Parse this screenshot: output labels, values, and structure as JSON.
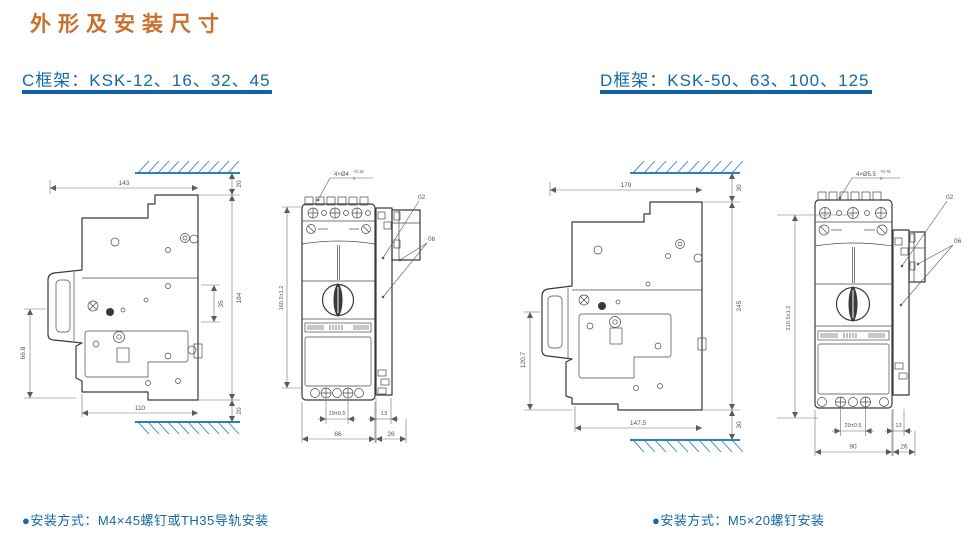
{
  "title": "外形及安装尺寸",
  "sections": {
    "c": {
      "heading": "C框架：KSK-12、16、32、45",
      "note": "●安装方式：M4×45螺钉或TH35导轨安装",
      "side": {
        "depth": "143",
        "gap_top": "20",
        "clip": "35",
        "height": "184",
        "front_h": "66.8",
        "base": "110",
        "gap_bottom": "20"
      },
      "front": {
        "hole": "4×Ø4",
        "tol_up": "+0.15",
        "tol_dn": "0",
        "callout_a": "02",
        "callout_b": "06",
        "height": "160.5±1.2",
        "spacing": "19±0.5",
        "aux": "13",
        "width": "66",
        "aux_w": "26"
      }
    },
    "d": {
      "heading": "D框架：KSK-50、63、100、125",
      "note": "●安装方式：M5×20螺钉安装",
      "side": {
        "depth": "179",
        "gap_top": "30",
        "height": "245",
        "front_h": "120.7",
        "base": "147.5",
        "gap_bottom": "30"
      },
      "front": {
        "hole": "4×Ø5.5",
        "tol_up": "+0.75",
        "tol_dn": "0",
        "callout_a": "02",
        "callout_b": "06",
        "height": "210.5±1.2",
        "spacing": "29±0.5",
        "aux": "13",
        "width": "90",
        "aux_w": "26"
      }
    }
  }
}
